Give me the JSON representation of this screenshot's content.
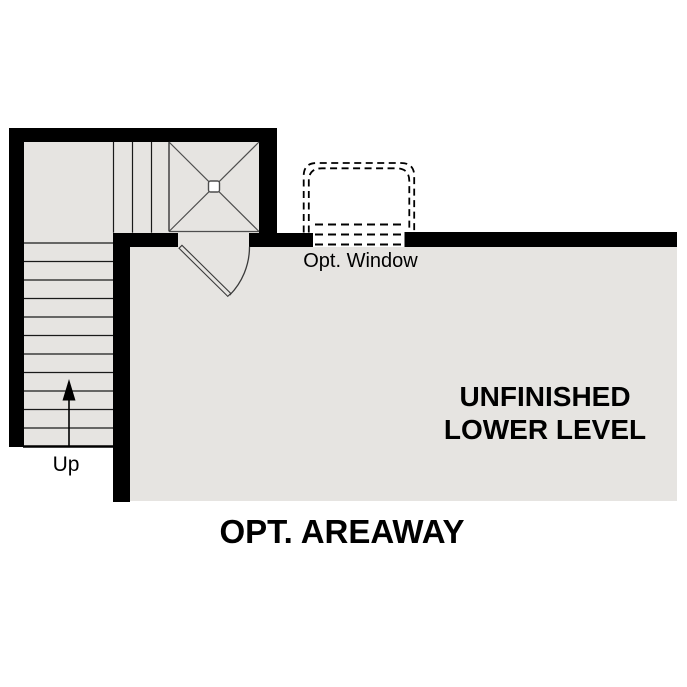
{
  "diagram": {
    "type": "floor-plan",
    "title": "OPT. AREAWAY",
    "room": {
      "name_line1": "UNFINISHED",
      "name_line2": "LOWER LEVEL"
    },
    "window_label": "Opt. Window",
    "stairs": {
      "direction_label": "Up",
      "direction_icon": "up-arrow-icon"
    }
  },
  "colors": {
    "wall": "#000000",
    "floor": "#e6e4e1",
    "line": "#1a1a1a",
    "hatch": "#4d4d4d",
    "door": "#3a3a3a",
    "bg": "#ffffff",
    "text": "#000000"
  }
}
